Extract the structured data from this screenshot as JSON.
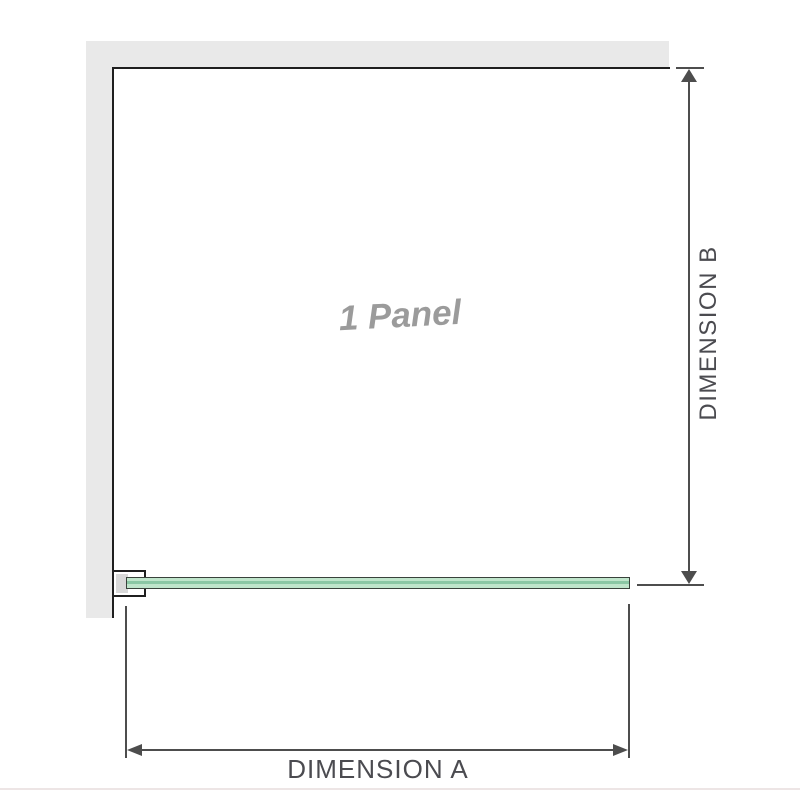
{
  "diagram": {
    "panel_label": "1 Panel",
    "dimension_a": {
      "label": "DIMENSION A",
      "axis": "horizontal"
    },
    "dimension_b": {
      "label": "DIMENSION B",
      "axis": "vertical"
    },
    "colors": {
      "wall": "#e9e9e9",
      "wall_edge": "#1f1f1f",
      "glass_fill": "#bfe5cb",
      "glass_core": "#8ac7a4",
      "glass_outline": "#39423b",
      "bracket_fill": "#d8d8d8",
      "dimension_line": "#4d4d4d",
      "label_text": "#4b4b50",
      "panel_label_text": "#9b9b9b",
      "footer_rule": "#ede5e5"
    }
  }
}
